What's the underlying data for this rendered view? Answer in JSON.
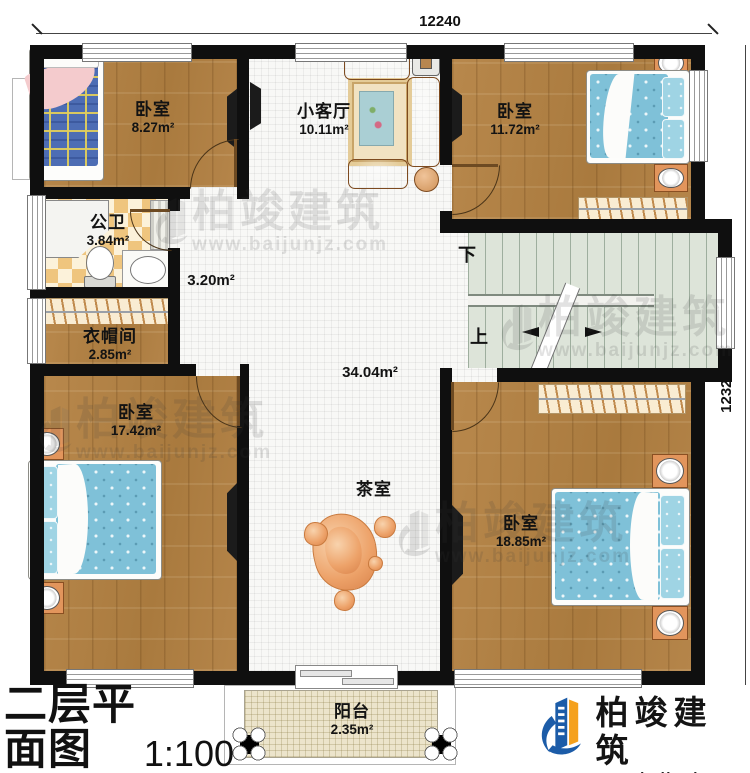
{
  "dimensions": {
    "top": "12240",
    "right": "12320"
  },
  "rooms": {
    "bedroom_tl": {
      "name": "卧室",
      "area": "8.27m²"
    },
    "living": {
      "name": "小客厅",
      "area": "10.11m²"
    },
    "bedroom_tr": {
      "name": "卧室",
      "area": "11.72m²"
    },
    "bathroom": {
      "name": "公卫",
      "area": "3.84m²"
    },
    "hallway": {
      "area": "3.20m²"
    },
    "cloakroom": {
      "name": "衣帽间",
      "area": "2.85m²"
    },
    "hall": {
      "area": "34.04m²"
    },
    "bedroom_bl": {
      "name": "卧室",
      "area": "17.42m²"
    },
    "tearoom": {
      "name": "茶室"
    },
    "bedroom_br": {
      "name": "卧室",
      "area": "18.85m²"
    },
    "balcony": {
      "name": "阳台",
      "area": "2.35m²"
    }
  },
  "stairs": {
    "down": "下",
    "up": "上"
  },
  "titleblock": {
    "title": "二层平面图",
    "scale": "1:100",
    "area_label": "本层建筑面积：",
    "area_value": "132.54m²",
    "height_label": "层高：",
    "height_value": "3.3m"
  },
  "brand": {
    "name": "柏竣建筑",
    "url": "www.baijunjz.com",
    "blue": "#1c5ca8",
    "orange": "#f5a11d"
  },
  "colors": {
    "wall": "#0f0f0f",
    "wood": "#b2813f",
    "stair_floor": "#dde4d9",
    "bed": "#7fc1d8"
  }
}
